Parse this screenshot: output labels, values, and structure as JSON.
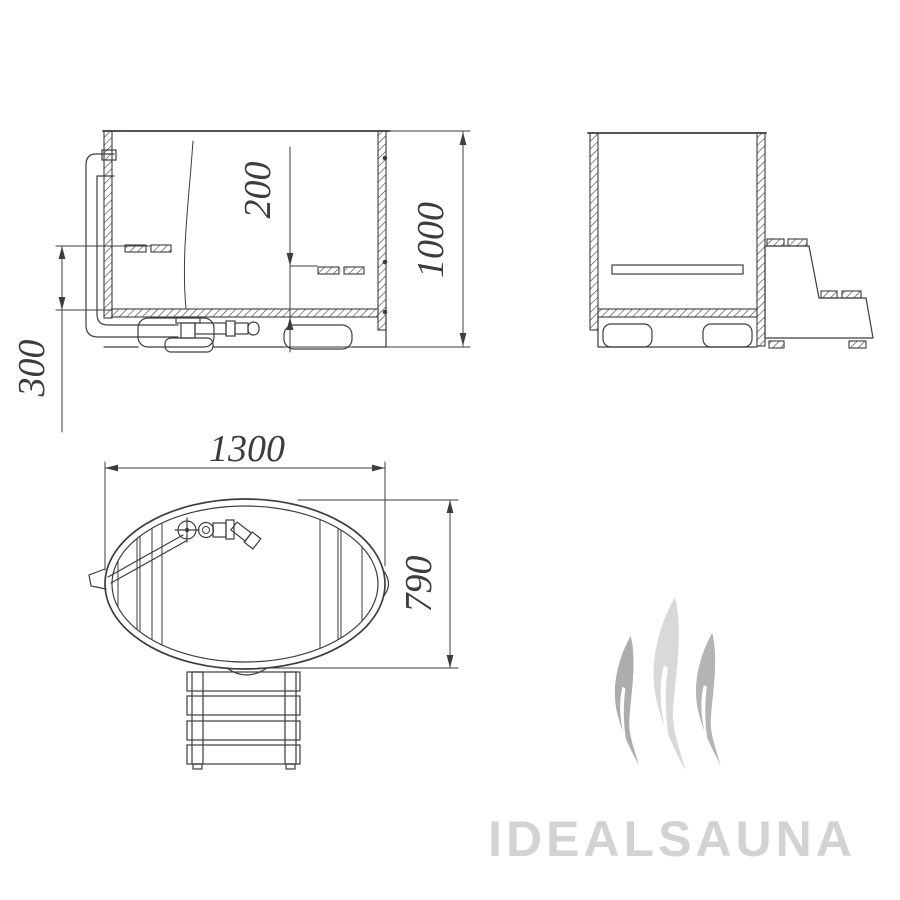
{
  "drawing": {
    "line_color": "#3d3d3d",
    "dimensions": {
      "seat_depth": "200",
      "overall_height": "1000",
      "seat_height": "300",
      "overall_length": "1300",
      "overall_width": "790"
    },
    "watermark": {
      "brand": "IDEALSAUNA",
      "text_color": "#d3d3d3",
      "flame_colors": {
        "left": "#adadad",
        "middle": "#d9d9d9",
        "right": "#b4b4b4"
      }
    }
  }
}
